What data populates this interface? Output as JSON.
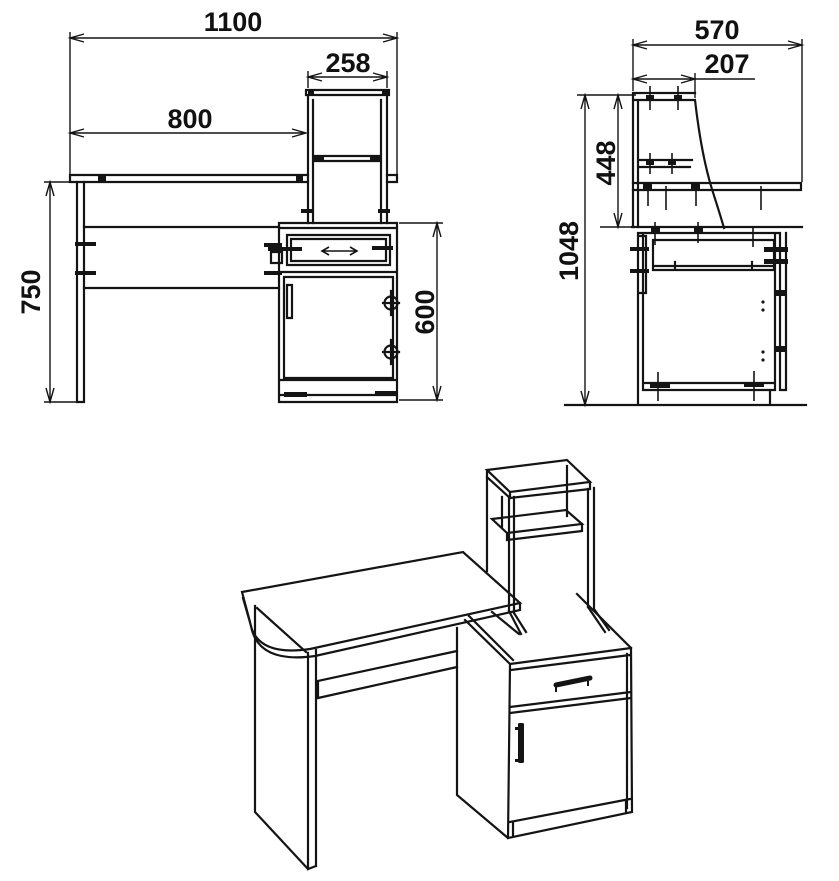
{
  "drawing": {
    "colors": {
      "background": "#ffffff",
      "line": "#141414",
      "text": "#111111"
    },
    "front_view": {
      "dims": {
        "overall_width": "1100",
        "shelf_width": "258",
        "desktop_span": "800",
        "desk_height": "750",
        "pedestal_height": "600"
      }
    },
    "side_view": {
      "dims": {
        "overall_depth": "570",
        "shelf_depth": "207",
        "shelf_height": "448",
        "overall_height": "1048"
      }
    }
  }
}
